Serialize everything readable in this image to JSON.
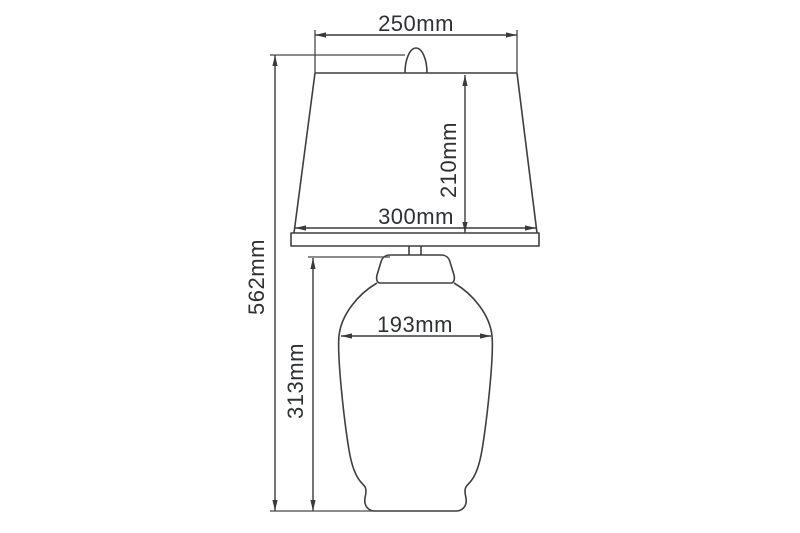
{
  "drawing": {
    "subject": "table-lamp-dimension-diagram",
    "unit": "mm",
    "line_color": "#3f3f3f",
    "text_color": "#2e3033",
    "background_color": "#ffffff",
    "labels": {
      "shade_top_width": "250mm",
      "shade_height": "210mm",
      "shade_bottom_width": "300mm",
      "overall_height": "562mm",
      "body_width": "193mm",
      "body_height": "313mm"
    }
  }
}
